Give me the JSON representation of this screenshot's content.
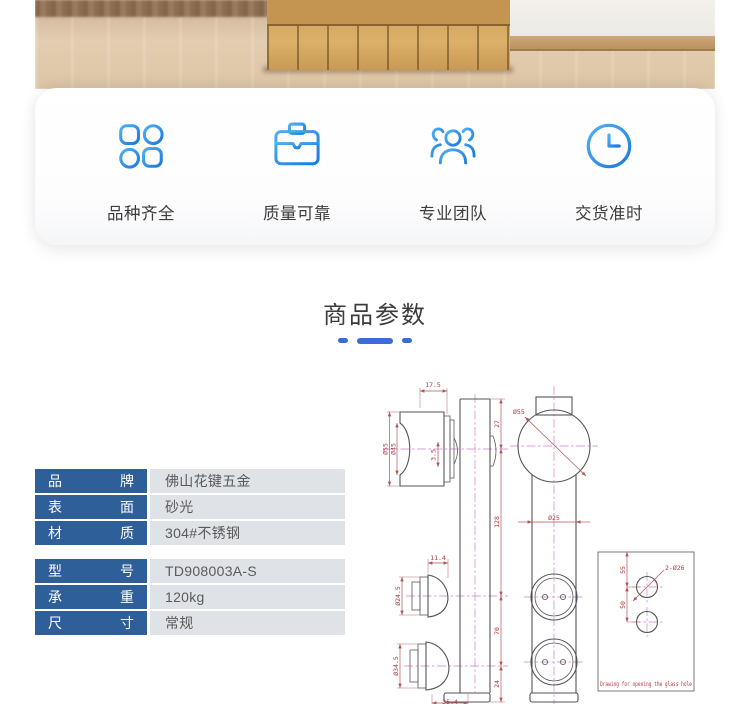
{
  "features": {
    "items": [
      {
        "icon": "grid-icon",
        "label": "品种齐全"
      },
      {
        "icon": "briefcase-icon",
        "label": "质量可靠"
      },
      {
        "icon": "team-icon",
        "label": "专业团队"
      },
      {
        "icon": "clock-icon",
        "label": "交货准时"
      }
    ]
  },
  "section": {
    "title": "商品参数"
  },
  "specs": {
    "rows": [
      {
        "k1": "品",
        "k2": "牌",
        "value": "佛山花键五金"
      },
      {
        "k1": "表",
        "k2": "面",
        "value": "砂光"
      },
      {
        "k1": "材",
        "k2": "质",
        "value": "304#不锈钢"
      },
      {
        "k1": "型",
        "k2": "号",
        "value": "TD908003A-S"
      },
      {
        "k1": "承",
        "k2": "重",
        "value": "120kg"
      },
      {
        "k1": "尺",
        "k2": "寸",
        "value": "常规"
      }
    ]
  },
  "drawing": {
    "dims": {
      "top_offset": "17.5",
      "bar_top_to_wheel": "27",
      "wheel_outer": "Ø55",
      "wheel_inner": "Ø45",
      "groove": "3.5",
      "wheel_to_clamp1": "128",
      "clamp_offset": "11.4",
      "clamp1_dia": "Ø24.5",
      "clamp2_dia": "Ø34.5",
      "clamp_spacing": "70",
      "clamp2_to_bottom": "24",
      "bottom_width": "35.4",
      "wheel_front": "Ø55",
      "bar_width": "Ø25",
      "glass_holes": "2-Ø26",
      "hole_top": "55",
      "hole_spacing": "50"
    },
    "note": "Drawing for opening the glass hole"
  },
  "colors": {
    "accent_blue": "#2f8ce8",
    "dash_blue": "#3a6bdb",
    "table_label_bg": "#2f5f98",
    "table_value_bg": "#dfe2e6",
    "dim_line": "#b05555",
    "dim_text": "#b03a3a",
    "center_line": "#cf7fd0",
    "geometry": "#555555"
  }
}
